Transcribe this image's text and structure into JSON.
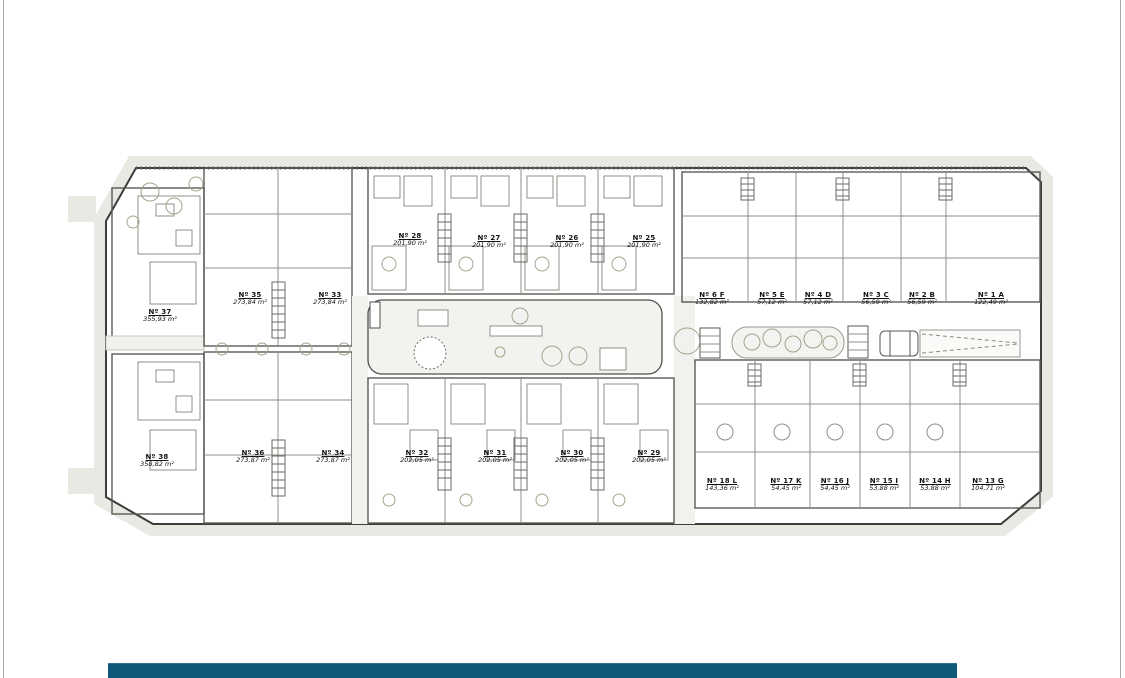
{
  "page": {
    "frame_color": "#a9a9a9",
    "background": "#ffffff"
  },
  "footer": {
    "bar_color": "#0e5878"
  },
  "plan": {
    "ink_color": "#3c3c3c",
    "paving_color": "#e9e9e4",
    "green_color": "#a9b69b",
    "units": [
      {
        "id": "37",
        "label": "Nº 37",
        "area": "355,93 m²"
      },
      {
        "id": "38",
        "label": "Nº 38",
        "area": "358,82 m²"
      },
      {
        "id": "35",
        "label": "Nº 35",
        "area": "273,84 m²"
      },
      {
        "id": "33",
        "label": "Nº 33",
        "area": "273,84 m²"
      },
      {
        "id": "36",
        "label": "Nº 36",
        "area": "273,87 m²"
      },
      {
        "id": "34",
        "label": "Nº 34",
        "area": "273,87 m²"
      },
      {
        "id": "28",
        "label": "Nº 28",
        "area": "201,90 m²"
      },
      {
        "id": "27",
        "label": "Nº 27",
        "area": "201,90 m²"
      },
      {
        "id": "26",
        "label": "Nº 26",
        "area": "201,90 m²"
      },
      {
        "id": "25",
        "label": "Nº 25",
        "area": "201,90 m²"
      },
      {
        "id": "32",
        "label": "Nº 32",
        "area": "202,05 m²"
      },
      {
        "id": "31",
        "label": "Nº 31",
        "area": "202,05 m²"
      },
      {
        "id": "30",
        "label": "Nº 30",
        "area": "202,05 m²"
      },
      {
        "id": "29",
        "label": "Nº 29",
        "area": "202,05 m²"
      },
      {
        "id": "6F",
        "label": "Nº 6 F",
        "area": "132,82 m²"
      },
      {
        "id": "5E",
        "label": "Nº 5 E",
        "area": "57,12 m²"
      },
      {
        "id": "4D",
        "label": "Nº 4 D",
        "area": "57,12 m²"
      },
      {
        "id": "3C",
        "label": "Nº 3 C",
        "area": "56,59 m²"
      },
      {
        "id": "2B",
        "label": "Nº 2 B",
        "area": "56,59 m²"
      },
      {
        "id": "1A",
        "label": "Nº 1 A",
        "area": "122,49 m²"
      },
      {
        "id": "18L",
        "label": "Nº 18 L",
        "area": "143,36 m²"
      },
      {
        "id": "17K",
        "label": "Nº 17 K",
        "area": "54,45 m²"
      },
      {
        "id": "16J",
        "label": "Nº 16 J",
        "area": "54,45 m²"
      },
      {
        "id": "15I",
        "label": "Nº 15 I",
        "area": "53,88 m²"
      },
      {
        "id": "14H",
        "label": "Nº 14 H",
        "area": "53,88 m²"
      },
      {
        "id": "13G",
        "label": "Nº 13 G",
        "area": "104,71 m²"
      }
    ]
  }
}
